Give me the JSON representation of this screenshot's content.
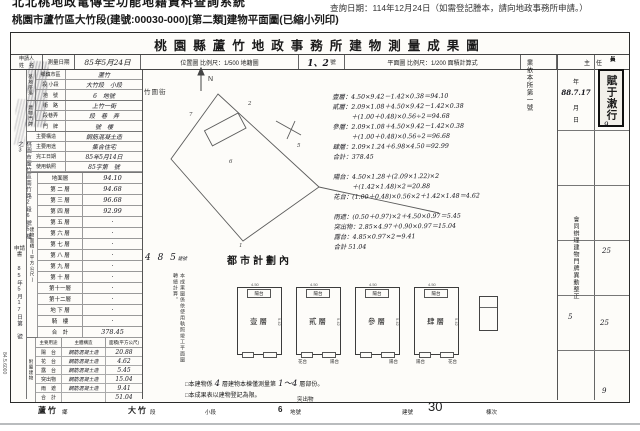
{
  "chrome": {
    "system_title": "北北桃地政電傳全功能地籍資料查詢系統",
    "doc_title": "桃園市蘆竹區大竹段(建號:00030-000)[第二類]建物平面圖(已縮小列印)",
    "query_date_note": "查詢日期：114年12月24日（如需登記謄本，請向地政事務所申請。）"
  },
  "sheet": {
    "title": "桃園縣蘆竹地政事務所建物測量成果圖",
    "header": {
      "applicant_label": "申請人",
      "name_label": "姓　名",
      "survey_date_label": "測量日期",
      "survey_date_value": "85年5月24日",
      "location_map_label": "位置圖 比例尺：1/500 地籍圖",
      "sheet_no_value": "1、2",
      "sheet_no_unit": "號",
      "floor_plan_label": "平面圖 比例尺：1/200 面積計算式",
      "approver_header": "主　任"
    },
    "margin": {
      "address_vertical": "桃園市蘆竹區南竹路2段6號5樓之3",
      "application_label": "申請書",
      "receipt_vertical": "85年5月17日第　號",
      "print_code": "84.5.6000"
    },
    "site": {
      "section_label": "基地座落",
      "rows": [
        {
          "label": "鄉鎮市區",
          "value": "蘆竹"
        },
        {
          "label": "段 小段",
          "value": "大竹段　小段"
        },
        {
          "label": "地　號",
          "value": "6　地號"
        }
      ]
    },
    "door": {
      "section_label": "建物門牌",
      "rows": [
        {
          "label": "街　路",
          "value": "上竹一街"
        },
        {
          "label": "段巷弄",
          "value": "段　巷　弄"
        },
        {
          "label": "門　牌",
          "value": "號　樓"
        }
      ]
    },
    "info_rows": [
      {
        "label": "主要構造",
        "value": "鋼筋混凝土造"
      },
      {
        "label": "主要用途",
        "value": "集合住宅"
      },
      {
        "label": "完工日期",
        "value": "85年5月14日"
      },
      {
        "label": "使用執照",
        "value": "85字第　號"
      }
    ],
    "floor_table": {
      "side_label": "建物面積(平方公尺)",
      "rows": [
        {
          "label": "地面層",
          "value": "94.10"
        },
        {
          "label": "第 二 層",
          "value": "94.68"
        },
        {
          "label": "第 三 層",
          "value": "96.68"
        },
        {
          "label": "第 四 層",
          "value": "92.99"
        },
        {
          "label": "第 五 層",
          "value": "·"
        },
        {
          "label": "第 六 層",
          "value": "·"
        },
        {
          "label": "第 七 層",
          "value": "·"
        },
        {
          "label": "第 八 層",
          "value": "·"
        },
        {
          "label": "第 九 層",
          "value": "·"
        },
        {
          "label": "第 十 層",
          "value": "·"
        },
        {
          "label": "第十一層",
          "value": "·"
        },
        {
          "label": "第十二層",
          "value": "·"
        },
        {
          "label": "地 下 層",
          "value": "·"
        },
        {
          "label": "騎　樓",
          "value": "·"
        },
        {
          "label": "合　計",
          "value": "378.45"
        }
      ]
    },
    "annex_table": {
      "side_label": "附屬建物",
      "headers": [
        "主要用途",
        "主體構造",
        "面積(平方公尺)"
      ],
      "rows": [
        {
          "use": "陽　台",
          "structure": "鋼筋混凝土造",
          "area": "20.88"
        },
        {
          "use": "花　台",
          "structure": "鋼筋混凝土造",
          "area": "4.62"
        },
        {
          "use": "露　台",
          "structure": "鋼筋混凝土造",
          "area": "5.45"
        },
        {
          "use": "突出物",
          "structure": "鋼筋混凝土造",
          "area": "15.04"
        },
        {
          "use": "雨　遮",
          "structure": "鋼筋混凝土造",
          "area": "9.41"
        },
        {
          "use": "合　計",
          "structure": "",
          "area": "51.04"
        }
      ]
    },
    "map": {
      "street_label": "竹圍街",
      "north_label": "N",
      "zone_note": "都市計劃內",
      "building_no_note": "4 8 5",
      "building_no_unit": "建號",
      "parcel_labels": [
        {
          "text": "6",
          "x": 218,
          "y": 126
        },
        {
          "text": "5",
          "x": 286,
          "y": 110
        },
        {
          "text": "7",
          "x": 178,
          "y": 79
        },
        {
          "text": "2",
          "x": 237,
          "y": 68
        },
        {
          "text": "1",
          "x": 228,
          "y": 210
        }
      ]
    },
    "transcribe_note": "本成果圖係依使用執照竣工平面圖轉繪計算。",
    "calc_lines": [
      "壹層：4.50×9.42－1.42×0.38＝94.10",
      "貳層：2.09×1.08＋4.50×9.42－1.42×0.38",
      "　　　＋(1.00＋0.48)×0.56÷2＝94.68",
      "參層：2.09×1.08＋4.50×9.42－1.42×0.38",
      "　　　＋(1.00＋0.48)×0.56÷2＝96.68",
      "肆層：2.09×1.24＋6.98×4.50＝92.99",
      "合計：378.45",
      "",
      "陽台：4.50×1.28＋(2.09×1.22)×2",
      "　　　＋(1.42×1.48)×2＝20.88",
      "花台：(1.00＋0.48)×0.56×2＋1.42×1.48＝4.62",
      "",
      "雨遮：(0.50＋0.97)×2＋4.50×0.97＝5.45",
      "突出物：2.85×4.97＋0.90×0.97＝15.04",
      "露台：4.85×0.97×2＝9.41",
      "合計 51.04"
    ],
    "plans": {
      "floors": [
        {
          "label": "壹層",
          "balcony": "陽台",
          "top_dim": "4.50",
          "side_dim": "9.42",
          "sub_left": "",
          "sub_right": ""
        },
        {
          "label": "貳層",
          "balcony": "陽台",
          "top_dim": "4.50",
          "side_dim": "9.42",
          "sub_left": "花台",
          "sub_right": "陽台"
        },
        {
          "label": "參層",
          "balcony": "陽台",
          "top_dim": "4.50",
          "side_dim": "9.42",
          "sub_left": "",
          "sub_right": "陽台"
        },
        {
          "label": "肆層",
          "balcony": "陽台",
          "top_dim": "4.50",
          "side_dim": "9.42",
          "sub_left": "陽台",
          "sub_right": "花台"
        }
      ]
    },
    "footnotes": {
      "line1_prefix": "□本建物係",
      "line1_hw1": "4",
      "line1_mid": "層建物本棟僅測量第",
      "line1_hw2": "1～4",
      "line1_suffix": "層部份。",
      "line2": "□本成果表以建物登記為限。",
      "projection_label": "突出物"
    },
    "approval": {
      "prefix_vertical": "業依本所第一號",
      "year_label": "年",
      "date_value": "88.7.17",
      "month_label": "月",
      "day_label": "日",
      "note_vertical": "會同辦理建物門牌異動整正"
    },
    "right_strip": {
      "seal_text": "賦于潄行",
      "cells": [
        {
          "label": "長"
        },
        {
          "label": "員"
        },
        {
          "label": "員"
        },
        {
          "label": "員"
        },
        {
          "label": "員"
        }
      ],
      "marks": [
        {
          "text": "9",
          "x": 46,
          "y": 66
        },
        {
          "text": "25",
          "x": 44,
          "y": 192
        },
        {
          "text": "5",
          "x": 10,
          "y": 258
        },
        {
          "text": "25",
          "x": 42,
          "y": 264
        },
        {
          "text": "9",
          "x": 44,
          "y": 332
        }
      ]
    },
    "footer_items": [
      {
        "text": "蘆竹",
        "cls": "f-bold",
        "x": 38
      },
      {
        "text": "鄉",
        "cls": "f-small",
        "x": 62
      },
      {
        "text": "大竹",
        "cls": "f-bold",
        "x": 128
      },
      {
        "text": "段",
        "cls": "f-small",
        "x": 150
      },
      {
        "text": "小段",
        "cls": "f-small",
        "x": 205
      },
      {
        "text": "6",
        "cls": "f-bold",
        "x": 278
      },
      {
        "text": "地號",
        "cls": "f-small",
        "x": 290
      },
      {
        "text": "建號",
        "cls": "f-small",
        "x": 402
      },
      {
        "text": "30",
        "cls": "f-hw",
        "x": 428
      },
      {
        "text": "棟次",
        "cls": "f-small",
        "x": 486
      }
    ]
  }
}
